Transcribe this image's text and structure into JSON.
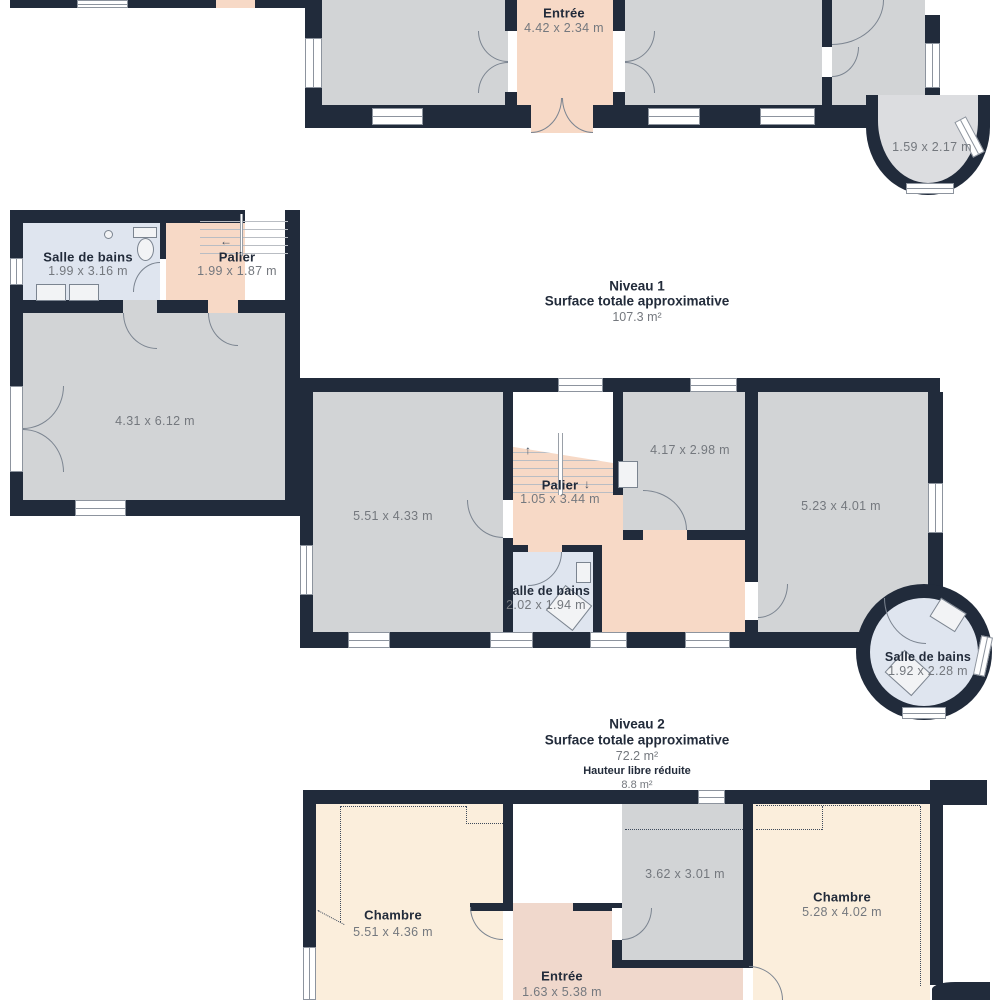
{
  "icons": {
    "up_arrow": "↑",
    "down_arrow": "↓",
    "left_arrow": "←"
  },
  "l0": {
    "entree": {
      "name": "Entrée",
      "dims": "4.42 x 2.34 m"
    },
    "bay": {
      "dims": "1.59 x 2.17 m"
    }
  },
  "l1h": {
    "title": "Niveau 1",
    "subtitle": "Surface totale approximative",
    "area": "107.3 m²"
  },
  "l1": {
    "bath_left": {
      "name": "Salle de bains",
      "dims": "1.99 x 3.16 m"
    },
    "palier_top": {
      "name": "Palier",
      "dims": "1.99 x 1.87 m"
    },
    "living": {
      "dims": "4.31 x 6.12 m"
    },
    "room_a": {
      "dims": "5.51 x 4.33 m"
    },
    "palier": {
      "name": "Palier",
      "dims": "1.05 x 3.44 m"
    },
    "room_b": {
      "dims": "4.17 x 2.98 m"
    },
    "room_c": {
      "dims": "5.23 x 4.01 m"
    },
    "bath_mid": {
      "name": "Salle de bains",
      "dims": "2.02 x 1.94 m"
    },
    "bath_round": {
      "name": "Salle de bains",
      "dims": "1.92 x 2.28 m"
    }
  },
  "l2h": {
    "title": "Niveau 2",
    "subtitle": "Surface totale approximative",
    "area": "72.2 m²",
    "note": "Hauteur libre réduite",
    "note_area": "8.8 m²"
  },
  "l2": {
    "chambre_left": {
      "name": "Chambre",
      "dims": "5.51 x 4.36 m"
    },
    "room_mid": {
      "dims": "3.62 x 3.01 m"
    },
    "chambre_right": {
      "name": "Chambre",
      "dims": "5.28 x 4.02 m"
    },
    "entree": {
      "name": "Entrée",
      "dims": "1.63 x 5.38 m"
    }
  },
  "colors": {
    "wall": "#212B3B",
    "room_gray": "#D2D4D6",
    "room_pink": "#F7D9C6",
    "room_cream": "#FBEEDC",
    "room_blue": "#DFE5EF",
    "text_dark": "#222B3A",
    "text_gray": "#74787E"
  }
}
